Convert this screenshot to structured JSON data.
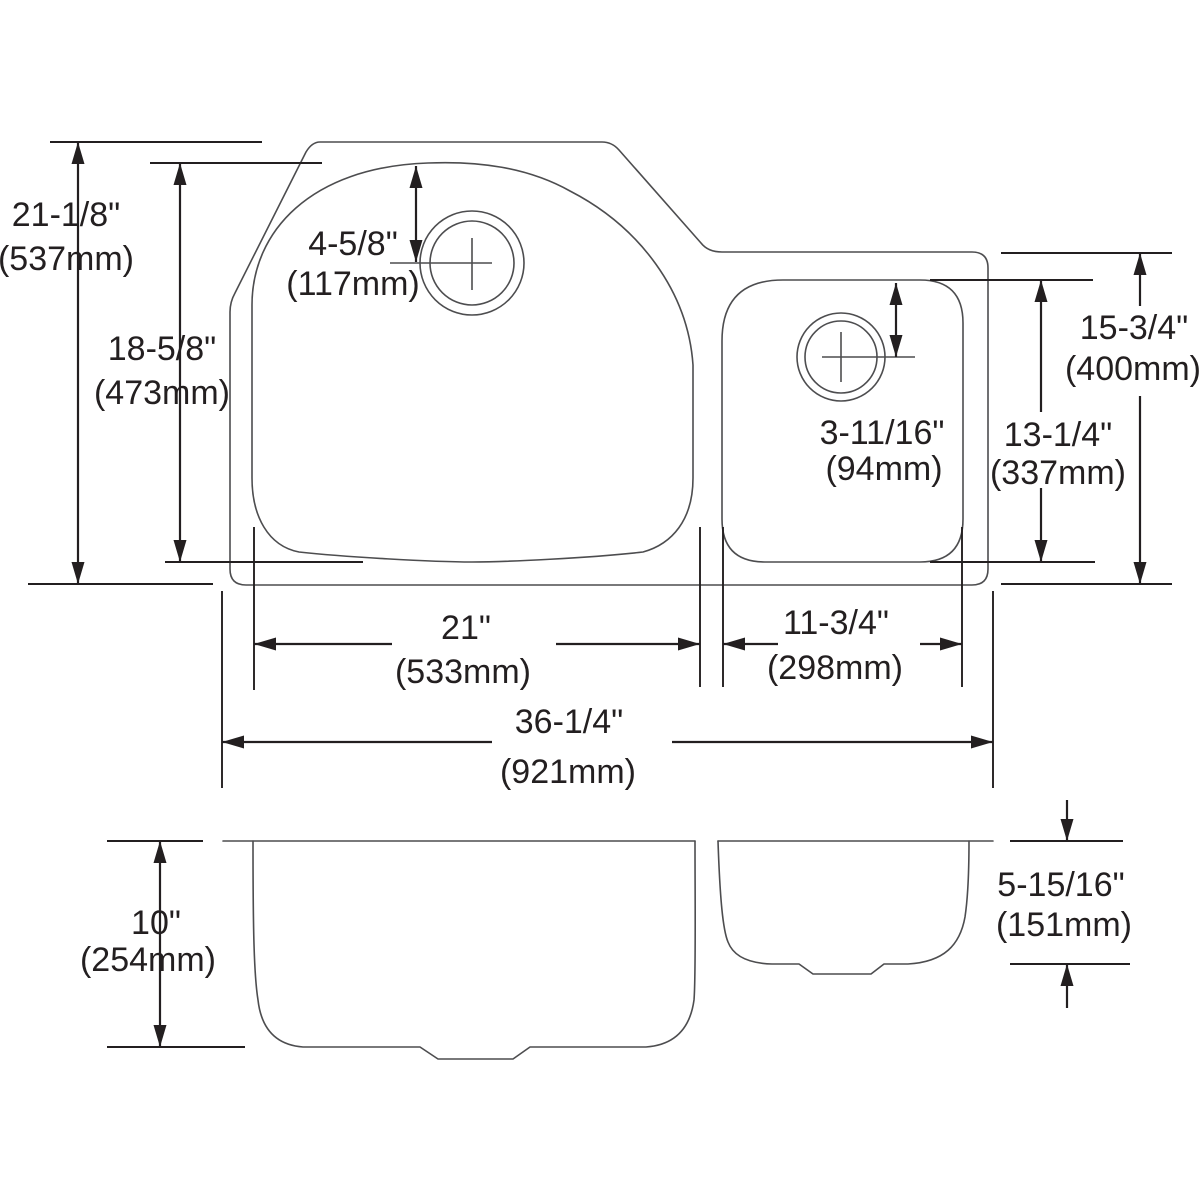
{
  "drawing": {
    "type": "sink-dimension-diagram",
    "background_color": "#ffffff",
    "outline_color": "#4d4d4f",
    "dimension_color": "#231f20",
    "views": {
      "top_view": "plan view of double-bowl sink",
      "front_view": "front elevation of double-bowl sink"
    },
    "dimensions": {
      "overall_front_to_back": {
        "in": "21-1/8\"",
        "mm": "(537mm)"
      },
      "left_bowl_front_to_back": {
        "in": "18-5/8\"",
        "mm": "(473mm)"
      },
      "left_drain_offset": {
        "in": "4-5/8\"",
        "mm": "(117mm)"
      },
      "right_section_front_to_back": {
        "in": "15-3/4\"",
        "mm": "(400mm)"
      },
      "right_bowl_front_to_back": {
        "in": "13-1/4\"",
        "mm": "(337mm)"
      },
      "right_drain_offset": {
        "in": "3-11/16\"",
        "mm": "(94mm)"
      },
      "left_bowl_width": {
        "in": "21\"",
        "mm": "(533mm)"
      },
      "right_bowl_width": {
        "in": "11-3/4\"",
        "mm": "(298mm)"
      },
      "overall_width": {
        "in": "36-1/4\"",
        "mm": "(921mm)"
      },
      "left_bowl_depth": {
        "in": "10\"",
        "mm": "(254mm)"
      },
      "right_bowl_depth": {
        "in": "5-15/16\"",
        "mm": "(151mm)"
      }
    }
  }
}
